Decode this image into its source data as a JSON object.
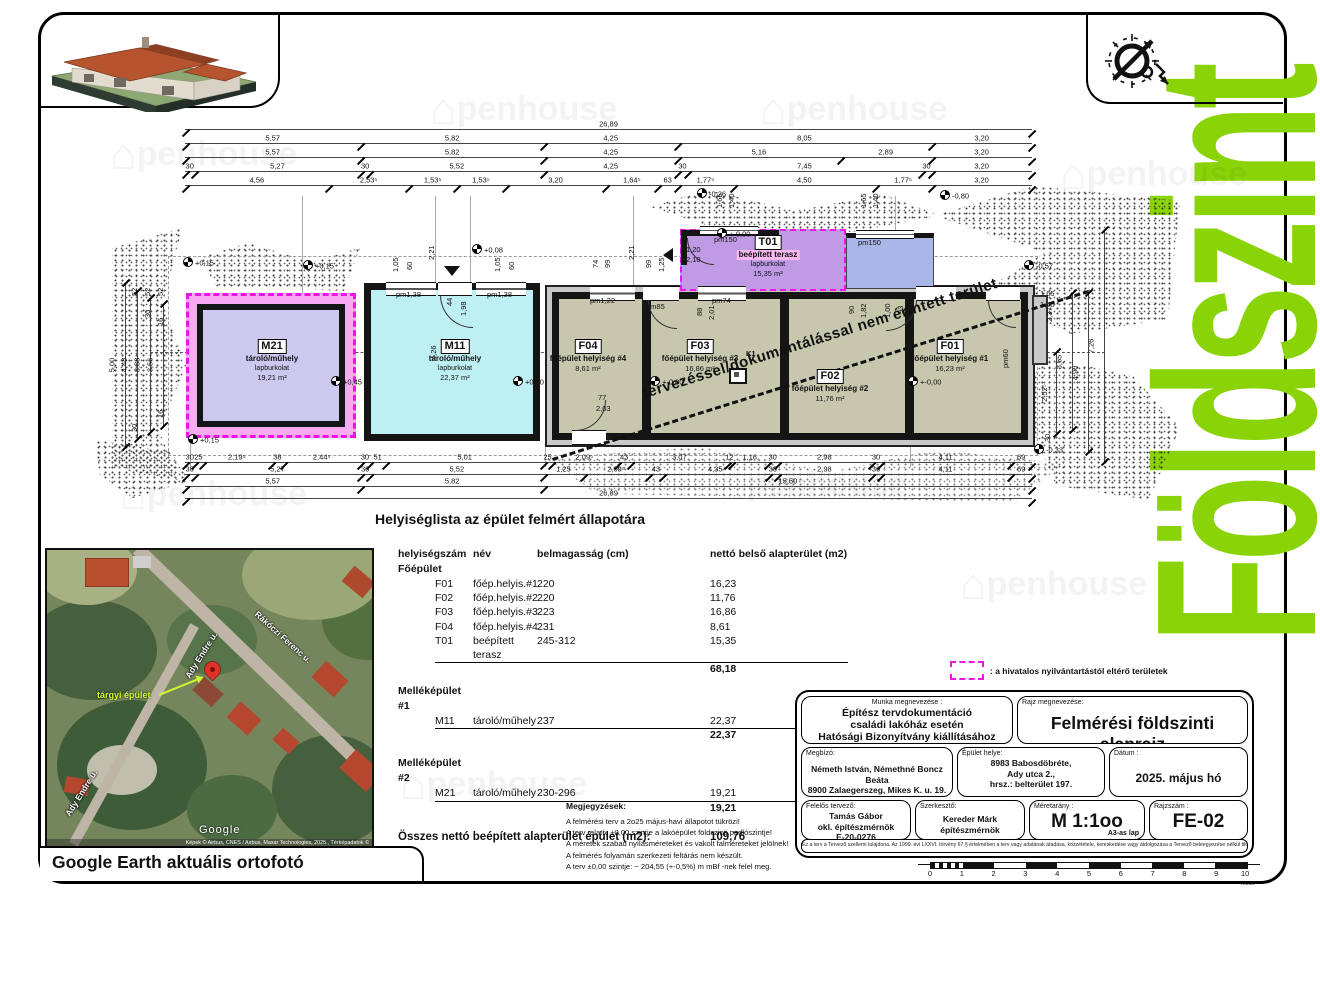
{
  "page": {
    "side_title": "Földszint",
    "plan_caption": "Helyiséglista az épület felmért állapotára",
    "diag_note": "tervezéssel/dokumentálással nem érintett terület",
    "legend_text": ": a hivatalos nyilvántartástól eltérő területek",
    "map_caption": "Google Earth aktuális ortofotó"
  },
  "colors": {
    "accent_green": "#8AD307",
    "magenta_dash": "#F013E8",
    "main_room_fill": "#C7C7AE",
    "m11_fill": "#BEEFF3",
    "m21_fill": "#CDC8EE",
    "t01_fill": "#C09BE5",
    "terrace_blue": "#ABB6E8"
  },
  "watermark": {
    "text": "penhouse",
    "glyph": "⌂"
  },
  "plan": {
    "rooms": {
      "m21": {
        "id": "M21",
        "name": "tároló/műhely",
        "finish": "lapburkolat",
        "area": "19,21 m²"
      },
      "m11": {
        "id": "M11",
        "name": "tároló/műhely",
        "finish": "lapburkolat",
        "area": "22,37 m²"
      },
      "f04": {
        "id": "F04",
        "name": "főépület helyiség #4",
        "area": "8,61 m²"
      },
      "f03": {
        "id": "F03",
        "name": "főépület helyiség #3",
        "area": "16,86 m²"
      },
      "f02": {
        "id": "F02",
        "name": "főépület helyiség #2",
        "area": "11,76 m²"
      },
      "f01": {
        "id": "F01",
        "name": "főépület helyiség #1",
        "area": "16,23 m²"
      },
      "t01": {
        "id": "T01",
        "name": "beépített terasz",
        "finish": "lapburkolat",
        "area": "15,35 m²"
      },
      "k1": "K1"
    },
    "h_chains": [
      {
        "y": 130,
        "x1": 185,
        "x2": 1032,
        "s": [
          [
            "26,89",
            2689
          ]
        ]
      },
      {
        "y": 144,
        "x1": 185,
        "x2": 1032,
        "s": [
          [
            "5,57",
            557
          ],
          [
            "5,82",
            582
          ],
          [
            "4,25",
            425
          ],
          [
            "8,05",
            805
          ],
          [
            "3,20",
            320
          ]
        ]
      },
      {
        "y": 158,
        "x1": 185,
        "x2": 1032,
        "s": [
          [
            "5,57",
            557
          ],
          [
            "5,82",
            582
          ],
          [
            "4,25",
            425
          ],
          [
            "5,16",
            516
          ],
          [
            "2,89",
            289
          ],
          [
            "3,20",
            320
          ]
        ]
      },
      {
        "y": 172,
        "x1": 185,
        "x2": 1032,
        "s": [
          [
            "30",
            30
          ],
          [
            "5,27",
            527
          ],
          [
            "30",
            30
          ],
          [
            "5,52",
            552
          ],
          [
            "4,25",
            425
          ],
          [
            "30",
            30
          ],
          [
            "7,45",
            745
          ],
          [
            "30",
            30
          ],
          [
            "3,20",
            320
          ]
        ]
      },
      {
        "y": 186,
        "x1": 185,
        "x2": 1032,
        "s": [
          [
            "4,56",
            456
          ],
          [
            "2,53⁵",
            253
          ],
          [
            "1,53⁵",
            153
          ],
          [
            "1,53⁵",
            153
          ],
          [
            "3,20",
            320
          ],
          [
            "1,64⁵",
            164
          ],
          [
            "63",
            63
          ],
          [
            "1,77⁵",
            177
          ],
          [
            "4,50",
            450
          ],
          [
            "1,77⁵",
            177
          ],
          [
            "3,20",
            320
          ]
        ]
      },
      {
        "y": 463,
        "x1": 185,
        "x2": 1032,
        "s": [
          [
            "30",
            30
          ],
          [
            "25",
            25
          ],
          [
            "2,19⁵",
            219
          ],
          [
            "38",
            38
          ],
          [
            "2,44⁵",
            244
          ],
          [
            "30",
            30
          ],
          [
            "51",
            51
          ],
          [
            "5,01",
            501
          ],
          [
            "25",
            25
          ],
          [
            "2,09⁵",
            209
          ],
          [
            "43",
            43
          ],
          [
            "3,07",
            307
          ],
          [
            "12",
            12
          ],
          [
            "1,16",
            116
          ],
          [
            "30",
            30
          ],
          [
            "2,98",
            298
          ],
          [
            "30",
            30
          ],
          [
            "4,11",
            411
          ],
          [
            "69",
            69
          ]
        ]
      },
      {
        "y": 475,
        "x1": 185,
        "x2": 1032,
        "s": [
          [
            "30",
            30
          ],
          [
            "5,27",
            527
          ],
          [
            "30",
            30
          ],
          [
            "5,52",
            552
          ],
          [
            "1,25",
            125
          ],
          [
            "2,09⁵",
            209
          ],
          [
            "43",
            43
          ],
          [
            "4,35",
            335
          ],
          [
            "30",
            30
          ],
          [
            "2,98",
            298
          ],
          [
            "30",
            30
          ],
          [
            "4,11",
            411
          ],
          [
            "69",
            69
          ]
        ]
      },
      {
        "y": 487,
        "x1": 185,
        "x2": 1032,
        "s": [
          [
            "5,57",
            557
          ],
          [
            "5,82",
            582
          ],
          [
            "15,50",
            1550
          ]
        ]
      },
      {
        "y": 499,
        "x1": 185,
        "x2": 1032,
        "s": [
          [
            "26,89",
            2689
          ]
        ]
      }
    ],
    "v_chains": [
      {
        "x": 125,
        "y1": 283,
        "y2": 447,
        "t": "5,00"
      },
      {
        "x": 137,
        "y1": 291,
        "y2": 439,
        "t": "4,48"
      },
      {
        "x": 150,
        "y1": 298,
        "y2": 432,
        "t": "3,88"
      },
      {
        "x": 163,
        "y1": 304,
        "y2": 426,
        "t": "3,56"
      },
      {
        "x": 1104,
        "y1": 230,
        "y2": 462,
        "t": "7,26"
      },
      {
        "x": 1088,
        "y1": 293,
        "y2": 452,
        "t": "4,90"
      },
      {
        "x": 1072,
        "y1": 293,
        "y2": 430,
        "t": "3,65"
      },
      {
        "x": 1056,
        "y1": 352,
        "y2": 434,
        "t": "2,52⁵"
      }
    ],
    "labels": [
      {
        "t": "+0,15",
        "x": 183,
        "y": 257,
        "lv": true
      },
      {
        "t": "+0,15",
        "x": 303,
        "y": 260,
        "lv": true
      },
      {
        "t": "+0,15",
        "x": 188,
        "y": 434,
        "lv": true
      },
      {
        "t": "+0,08",
        "x": 472,
        "y": 244,
        "lv": true
      },
      {
        "t": "+0,45",
        "x": 331,
        "y": 376,
        "lv": true
      },
      {
        "t": "+0,20",
        "x": 513,
        "y": 376,
        "lv": true
      },
      {
        "t": "+-0,00",
        "x": 650,
        "y": 376,
        "lv": true
      },
      {
        "t": "+-0,00",
        "x": 908,
        "y": 376,
        "lv": true
      },
      {
        "t": "+-0,00",
        "x": 717,
        "y": 228,
        "lv": true
      },
      {
        "t": "-0,26",
        "x": 697,
        "y": 188,
        "lv": true
      },
      {
        "t": "-0,80",
        "x": 940,
        "y": 190,
        "lv": true
      },
      {
        "t": "-0,57",
        "x": 1024,
        "y": 260,
        "lv": true
      },
      {
        "t": "-0,33",
        "x": 1034,
        "y": 444,
        "lv": true
      },
      {
        "t": "pm1,38",
        "x": 396,
        "y": 291
      },
      {
        "t": "pm1,38",
        "x": 487,
        "y": 291
      },
      {
        "t": "pm1,22",
        "x": 590,
        "y": 297
      },
      {
        "t": "pm85",
        "x": 646,
        "y": 303
      },
      {
        "t": "pm74",
        "x": 712,
        "y": 297
      },
      {
        "t": "pm150",
        "x": 714,
        "y": 236
      },
      {
        "t": "pm150",
        "x": 858,
        "y": 239
      },
      {
        "t": "pm60",
        "x": 1002,
        "y": 368,
        "r": -90
      },
      {
        "t": "77",
        "x": 598,
        "y": 394
      },
      {
        "t": "2,03",
        "x": 596,
        "y": 405
      },
      {
        "t": "1,20",
        "x": 686,
        "y": 246
      },
      {
        "t": "2,10",
        "x": 686,
        "y": 256
      },
      {
        "t": "1,05",
        "x": 392,
        "y": 272,
        "r": -90
      },
      {
        "t": "60",
        "x": 406,
        "y": 270,
        "r": -90
      },
      {
        "t": "2,21",
        "x": 428,
        "y": 260,
        "r": -90
      },
      {
        "t": "44",
        "x": 446,
        "y": 306,
        "r": -90
      },
      {
        "t": "1,98",
        "x": 460,
        "y": 316,
        "r": -90
      },
      {
        "t": "1,05",
        "x": 494,
        "y": 272,
        "r": -90
      },
      {
        "t": "60",
        "x": 508,
        "y": 270,
        "r": -90
      },
      {
        "t": "74",
        "x": 592,
        "y": 268,
        "r": -90
      },
      {
        "t": "99",
        "x": 604,
        "y": 268,
        "r": -90
      },
      {
        "t": "2,21",
        "x": 628,
        "y": 260,
        "r": -90
      },
      {
        "t": "99",
        "x": 645,
        "y": 268,
        "r": -90
      },
      {
        "t": "1,25",
        "x": 658,
        "y": 272,
        "r": -90
      },
      {
        "t": "1,65",
        "x": 716,
        "y": 208,
        "r": -90
      },
      {
        "t": "1,40",
        "x": 728,
        "y": 208,
        "r": -90
      },
      {
        "t": "1,65",
        "x": 860,
        "y": 208,
        "r": -90
      },
      {
        "t": "1,40",
        "x": 872,
        "y": 208,
        "r": -90
      },
      {
        "t": "88",
        "x": 696,
        "y": 316,
        "r": -90
      },
      {
        "t": "2,01",
        "x": 708,
        "y": 320,
        "r": -90
      },
      {
        "t": "90",
        "x": 848,
        "y": 314,
        "r": -90
      },
      {
        "t": "1,82",
        "x": 860,
        "y": 318,
        "r": -90
      },
      {
        "t": "1,00",
        "x": 884,
        "y": 318,
        "r": -90
      },
      {
        "t": "93",
        "x": 897,
        "y": 314,
        "r": -90
      },
      {
        "t": "52",
        "x": 131,
        "y": 296,
        "r": -90
      },
      {
        "t": "52",
        "x": 144,
        "y": 296,
        "r": -90
      },
      {
        "t": "52",
        "x": 157,
        "y": 296,
        "r": -90
      },
      {
        "t": "30",
        "x": 144,
        "y": 318,
        "r": -90
      },
      {
        "t": "16",
        "x": 157,
        "y": 326,
        "r": -90
      },
      {
        "t": "16",
        "x": 157,
        "y": 418,
        "r": -90
      },
      {
        "t": "30",
        "x": 131,
        "y": 432,
        "r": -90
      },
      {
        "t": "4,26",
        "x": 430,
        "y": 360,
        "r": -90
      },
      {
        "t": "3,95",
        "x": 643,
        "y": 362,
        "r": -90
      },
      {
        "t": "1,65",
        "x": 1040,
        "y": 290
      },
      {
        "t": "1,40",
        "x": 1040,
        "y": 301
      },
      {
        "t": "2,37⁵",
        "x": 1046,
        "y": 322,
        "r": -90
      },
      {
        "t": "30",
        "x": 1044,
        "y": 442,
        "r": -90
      }
    ]
  },
  "room_table": {
    "rows": [
      {
        "h": [
          "helyiségszám",
          "név",
          "belmagasság (cm)",
          "nettó belső alapterület (m2)"
        ]
      },
      {
        "g": "Főépület"
      },
      {
        "r": [
          "F01",
          "főép.helyis.#1",
          "220",
          "16,23"
        ]
      },
      {
        "r": [
          "F02",
          "főép.helyis.#2",
          "220",
          "11,76"
        ]
      },
      {
        "r": [
          "F03",
          "főép.helyis.#3",
          "223",
          "16,86"
        ]
      },
      {
        "r": [
          "F04",
          "főép.helyis.#4",
          "231",
          "8,61"
        ]
      },
      {
        "r": [
          "T01",
          "beépített terasz",
          "245-312",
          "15,35"
        ]
      },
      {
        "s": "68,18"
      },
      {
        "sp": 7
      },
      {
        "g": "Melléképület #1"
      },
      {
        "r": [
          "M11",
          "tároló/műhely",
          "237",
          "22,37"
        ]
      },
      {
        "s": "22,37"
      },
      {
        "sp": 13
      },
      {
        "g": "Melléképület #2"
      },
      {
        "r": [
          "M21",
          "tároló/műhely",
          "230-296",
          "19,21"
        ]
      },
      {
        "s": "19,21"
      },
      {
        "sp": 13
      },
      {
        "tot": [
          "Összes nettó beépített alapterület épület (m2):",
          "109,76"
        ]
      }
    ]
  },
  "notes": {
    "title": "Megjegyzések:",
    "lines": [
      "A felmérési terv a 2o25 május-havi állapotot tükrözi!",
      "A terv relatív ±0,00 szintje a lakóépület földszinti padlószintje!",
      "A méretek szabad nyílásméreteket és vakolt falméreteket jelölnek!",
      "A felmérés folyamán szerkezeti feltárás nem készült.",
      "A terv ±0,00 szintje: ~ 204,55 (+-0,5%) m mBf -nek felel meg."
    ]
  },
  "titleblock": {
    "work_label": "Munka megnevezése :",
    "work_lines": [
      "Építész tervdokumentáció",
      "családi lakóház esetén",
      "Hatósági Bizonyítvány kiállításához"
    ],
    "drawing_label": "Rajz megnevezése:",
    "drawing_title": "Felmérési földszinti alaprajz",
    "client_label": "Megbízó:",
    "client_lines": [
      "Németh István, Némethné Boncz Beáta",
      "8900 Zalaegerszeg, Mikes K. u. 19."
    ],
    "site_label": "Épület helye:",
    "site_lines": [
      "8983 Babosdöbréte,",
      "Ady utca 2.,",
      "hrsz.: belterület 197."
    ],
    "date_label": "Dátum :",
    "date_value": "2025. május hó",
    "designer_label": "Felelős tervező:",
    "designer_lines": [
      "Tamás Gábor",
      "okl. építészmérnök",
      "E-20-0276"
    ],
    "editor_label": "Szerkesztő:",
    "editor_lines": [
      "Kereder Márk",
      "építészmérnök"
    ],
    "scale_label": "Méretarány :",
    "scale_value": "M 1:1oo",
    "sheet_size": "A3-as lap",
    "number_label": "Rajzszám :",
    "number_value": "FE-02",
    "legal": "Ez a terv a Tervező szellemi tulajdona. Az 1999. évi LXXVI. törvény 67.§ értelmében a terv vagy adatának átadása, közzététele, kereskedése vagy átdolgozása a Tervező beleegyezése nélkül tilos!"
  },
  "scalebar": {
    "numbers": [
      "0",
      "1",
      "2",
      "3",
      "4",
      "5",
      "6",
      "7",
      "8",
      "9",
      "10"
    ],
    "unit": "méter"
  },
  "map": {
    "streets": [
      "Ady Endre u.",
      "Rákóczi Ferenc u.",
      "Ady Endre u."
    ],
    "target_label": "tárgyi épület",
    "google": "Google",
    "attribution": "Képek © Airbus, CNES / Airbus, Maxar Technologies, 2025., Térképadatok ©"
  }
}
